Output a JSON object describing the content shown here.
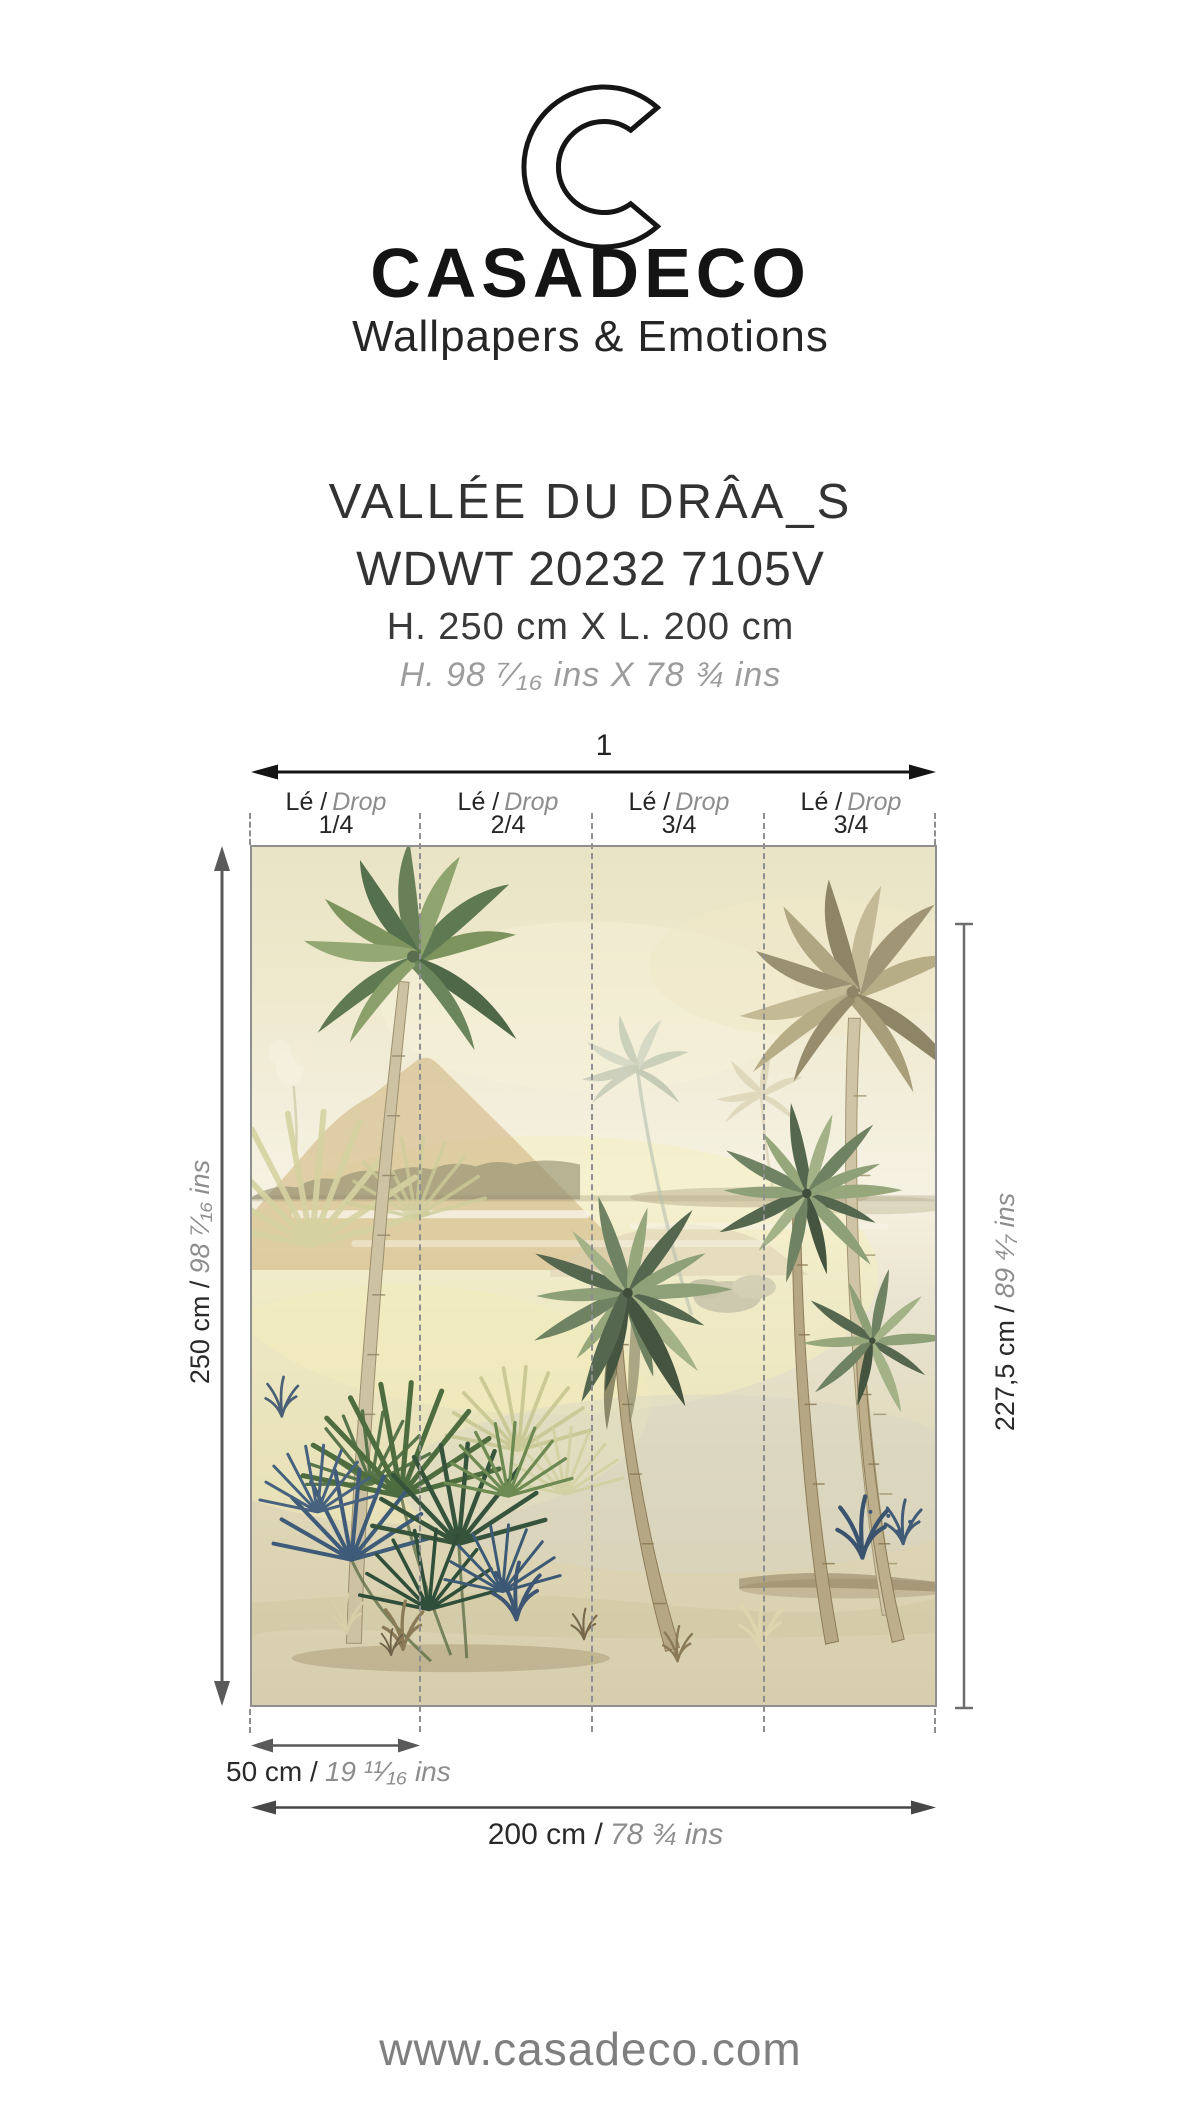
{
  "palette": {
    "page_bg": "#ffffff",
    "ink": "#141414",
    "text_dark": "#2a2a2a",
    "text_mid": "#333333",
    "text_gray": "#8d8d8d",
    "italic_gray": "#9c9c9c",
    "dash_gray": "#8f8f8f",
    "arrow_black": "#141414",
    "arrow_gray": "#5a5a5a",
    "arrow_dark": "#474747",
    "tline_gray": "#6e6e6e",
    "border_gray": "#8f8f8f",
    "footer_gray": "#7f7f7f"
  },
  "header": {
    "brand": "CASADECO",
    "tagline": "Wallpapers & Emotions",
    "logo_icon": "casadeco-c-logo"
  },
  "product": {
    "name": "VALLÉE DU DRÂA_S",
    "reference": "WDWT 20232 7105V",
    "size_cm": "H. 250 cm X L. 200 cm",
    "size_ins": "H. 98 ⁷⁄₁₆ ins X 78 ¾ ins"
  },
  "diagram": {
    "roll_label": "1",
    "drops": [
      {
        "fr": "Lé /",
        "en": "Drop",
        "fraction": "1/4"
      },
      {
        "fr": "Lé /",
        "en": "Drop",
        "fraction": "2/4"
      },
      {
        "fr": "Lé /",
        "en": "Drop",
        "fraction": "3/4"
      },
      {
        "fr": "Lé /",
        "en": "Drop",
        "fraction": "3/4"
      }
    ],
    "dim_height_total": {
      "cm": "250 cm /",
      "ins": "98 ⁷⁄₁₆ ins"
    },
    "dim_height_right": {
      "cm": "227,5 cm /",
      "ins": "89 ⁴⁄₇ ins"
    },
    "dim_drop_width": {
      "cm": "50 cm /",
      "ins": "19 ¹¹⁄₁₆ ins"
    },
    "dim_total_width": {
      "cm": "200 cm /",
      "ins": "78 ¾ ins"
    }
  },
  "footer": {
    "url": "www.casadeco.com"
  }
}
